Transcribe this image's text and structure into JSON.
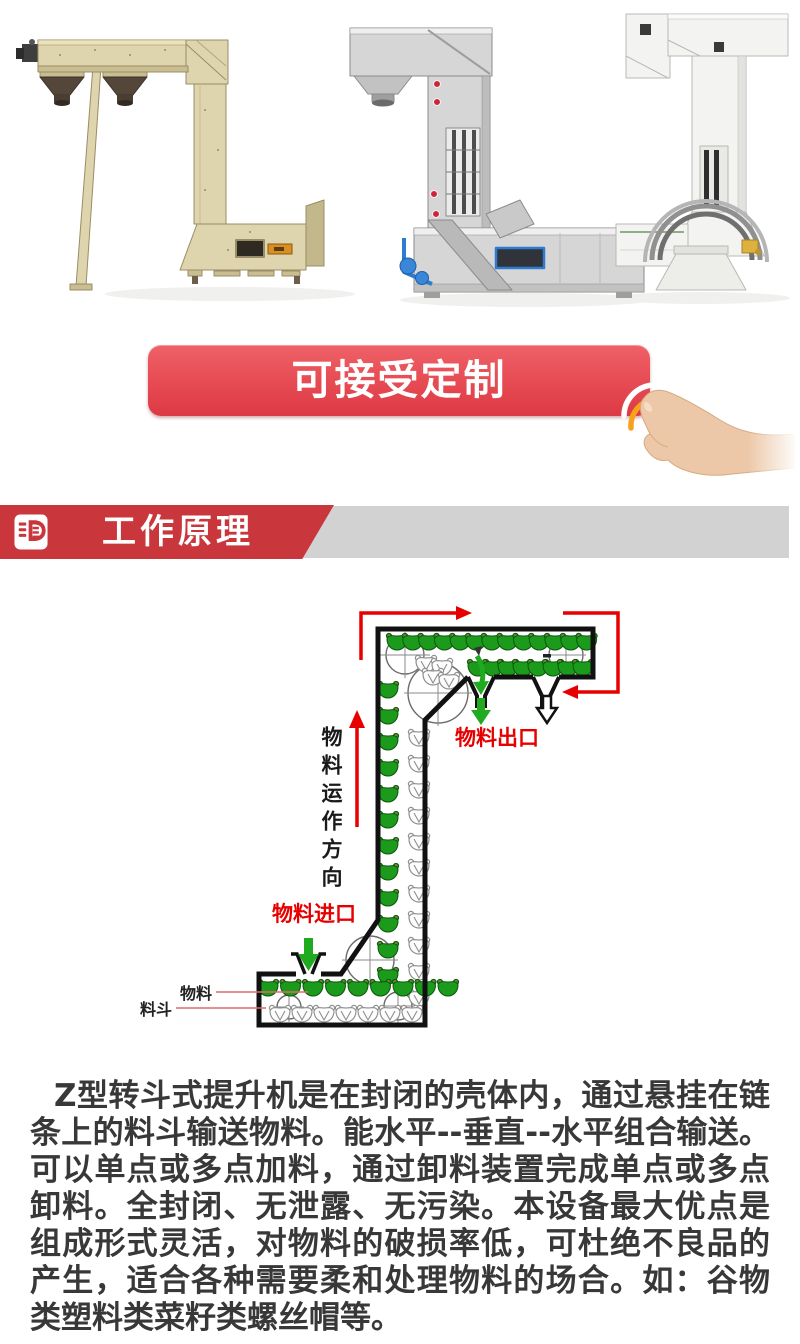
{
  "photos": {
    "items": [
      {
        "name": "z-bucket-elevator-beige"
      },
      {
        "name": "z-bucket-elevator-stainless"
      },
      {
        "name": "z-bucket-elevator-white"
      }
    ]
  },
  "cta": {
    "label": "可接受定制"
  },
  "section_header": {
    "title": "工作原理",
    "red": "#c9363c",
    "gray": "#d2d2d2"
  },
  "diagram": {
    "direction_label": "物料运作方向",
    "outlet_label": "物料出口",
    "inlet_label": "物料进口",
    "material_label": "物料",
    "bucket_label": "料斗",
    "colors": {
      "bucket_green": "#1c9a1c",
      "bucket_green_dark": "#0a5a0a",
      "bucket_gray": "#8f8f8f",
      "arrow_red": "#e60000",
      "arrow_green": "#1faa1f",
      "outline": "#111111"
    },
    "bucket_rows": [
      {
        "type": "green",
        "x0": 397,
        "y0": 52,
        "dx": 15.8,
        "dy": 0,
        "n": 13
      },
      {
        "type": "green",
        "x0": 478,
        "y0": 78,
        "dx": 15,
        "dy": 0,
        "n": 8
      },
      {
        "type": "green",
        "x0": 388,
        "y0": 100,
        "dx": 0,
        "dy": 26,
        "n": 12
      },
      {
        "type": "gray",
        "x0": 419,
        "y0": 148,
        "dx": 0,
        "dy": 26,
        "n": 11
      },
      {
        "type": "green",
        "x0": 268,
        "y0": 398,
        "dx": 22.5,
        "dy": 0,
        "n": 9
      },
      {
        "type": "gray",
        "x0": 280,
        "y0": 424,
        "dx": 22,
        "dy": 0,
        "n": 7
      }
    ],
    "extra_gray": [
      [
        426,
        74
      ],
      [
        442,
        77
      ],
      [
        433,
        87
      ],
      [
        449,
        91
      ]
    ]
  },
  "description": {
    "text": "Z型转斗式提升机是在封闭的壳体内，通过悬挂在链条上的料斗输送物料。能水平--垂直--水平组合输送。可以单点或多点加料，通过卸料装置完成单点或多点卸料。全封闭、无泄露、无污染。本设备最大优点是组成形式灵活，对物料的破损率低，可杜绝不良品的产生，适合各种需要柔和处理物料的场合。如：谷物类塑料类菜籽类螺丝帽等。"
  }
}
